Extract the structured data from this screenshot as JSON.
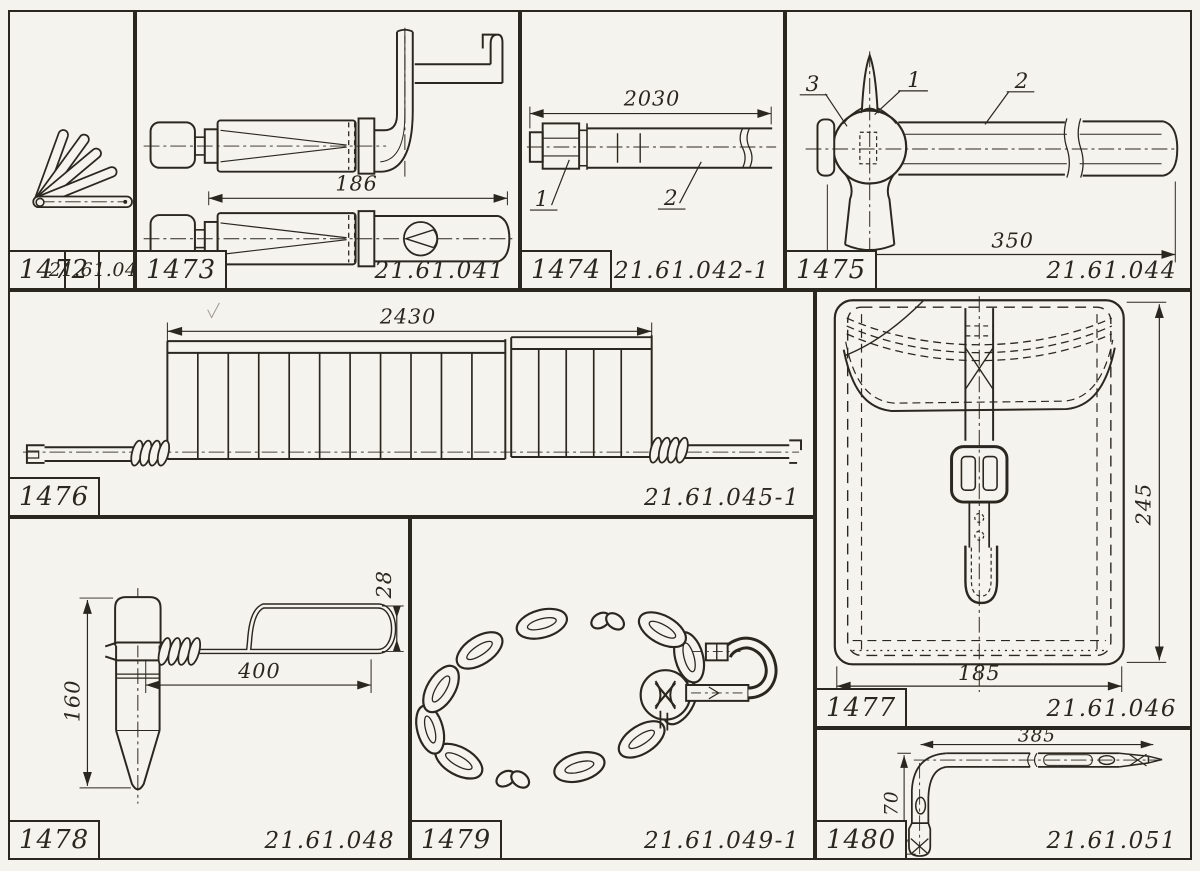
{
  "page": {
    "background": "#f5f3ed",
    "ink": "#2a2620"
  },
  "panels": {
    "p1472": {
      "item": "1472",
      "part": "21.61.040"
    },
    "p1473": {
      "item": "1473",
      "part": "21.61.041",
      "dims": {
        "length": "186"
      }
    },
    "p1474": {
      "item": "1474",
      "part": "21.61.042-1",
      "dims": {
        "length": "2030"
      },
      "callouts": {
        "c1": "1",
        "c2": "2"
      }
    },
    "p1475": {
      "item": "1475",
      "part": "21.61.044",
      "dims": {
        "length": "350"
      },
      "callouts": {
        "c1": "1",
        "c2": "2",
        "c3": "3"
      }
    },
    "p1476": {
      "item": "1476",
      "part": "21.61.045-1",
      "dims": {
        "length": "2430"
      }
    },
    "p1477": {
      "item": "1477",
      "part": "21.61.046",
      "dims": {
        "height": "245",
        "width": "185"
      }
    },
    "p1478": {
      "item": "1478",
      "part": "21.61.048",
      "dims": {
        "height": "160",
        "length": "400",
        "loop": "28"
      }
    },
    "p1479": {
      "item": "1479",
      "part": "21.61.049-1"
    },
    "p1480": {
      "item": "1480",
      "part": "21.61.051",
      "dims": {
        "length": "385",
        "height": "170"
      }
    }
  }
}
